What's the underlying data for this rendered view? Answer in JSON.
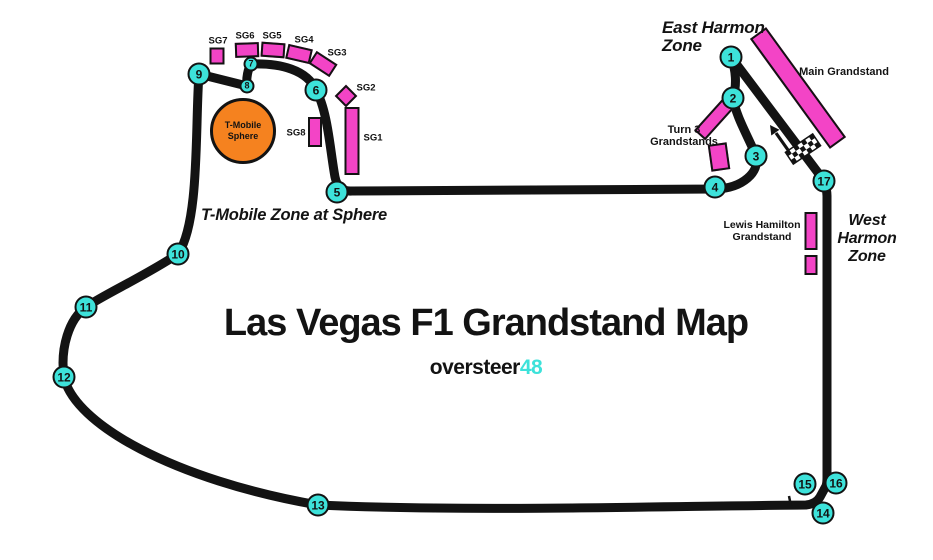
{
  "title": "Las Vegas F1 Grandstand Map",
  "brand": {
    "name": "oversteer",
    "number": "48"
  },
  "colors": {
    "pink": "#f344c6",
    "cyan": "#3de2da",
    "orange": "#f5821f",
    "track": "#131313",
    "background": "#ffffff"
  },
  "sphere": {
    "line1": "T-Mobile",
    "line2": "Sphere"
  },
  "zones": {
    "east_harmon": {
      "lines": [
        "East Harmon",
        "Zone"
      ]
    },
    "west_harmon": {
      "lines": [
        "West",
        "Harmon",
        "Zone"
      ]
    },
    "sphere_zone": {
      "lines": [
        "T-Mobile Zone at Sphere"
      ]
    },
    "turn3_label": {
      "lines": [
        "Turn 3",
        "Grandstands"
      ]
    },
    "lewis_label": {
      "lines": [
        "Lewis Hamilton",
        "Grandstand"
      ]
    },
    "main_label": {
      "lines": [
        "Main Grandstand"
      ]
    }
  },
  "turns": [
    {
      "n": "1",
      "x": 731,
      "y": 57,
      "size": "large"
    },
    {
      "n": "2",
      "x": 733,
      "y": 98,
      "size": "large"
    },
    {
      "n": "3",
      "x": 756,
      "y": 156,
      "size": "large"
    },
    {
      "n": "4",
      "x": 715,
      "y": 187,
      "size": "large"
    },
    {
      "n": "5",
      "x": 337,
      "y": 192,
      "size": "large"
    },
    {
      "n": "6",
      "x": 316,
      "y": 90,
      "size": "large"
    },
    {
      "n": "7",
      "x": 251,
      "y": 64,
      "size": "small"
    },
    {
      "n": "8",
      "x": 247,
      "y": 86,
      "size": "small"
    },
    {
      "n": "9",
      "x": 199,
      "y": 74,
      "size": "large"
    },
    {
      "n": "10",
      "x": 178,
      "y": 254,
      "size": "large"
    },
    {
      "n": "11",
      "x": 86,
      "y": 307,
      "size": "large"
    },
    {
      "n": "12",
      "x": 64,
      "y": 377,
      "size": "large"
    },
    {
      "n": "13",
      "x": 318,
      "y": 505,
      "size": "large"
    },
    {
      "n": "14",
      "x": 823,
      "y": 513,
      "size": "large"
    },
    {
      "n": "15",
      "x": 805,
      "y": 484,
      "size": "large"
    },
    {
      "n": "16",
      "x": 836,
      "y": 483,
      "size": "large"
    },
    {
      "n": "17",
      "x": 824,
      "y": 181,
      "size": "large"
    }
  ],
  "grandstands": [
    {
      "id": "sg7",
      "label": "SG7",
      "x": 217,
      "y": 56,
      "w": 15,
      "h": 17,
      "rot": 0,
      "lx": 218,
      "ly": 41
    },
    {
      "id": "sg6",
      "label": "SG6",
      "x": 247,
      "y": 50,
      "w": 24,
      "h": 15,
      "rot": -2,
      "lx": 245,
      "ly": 36
    },
    {
      "id": "sg5",
      "label": "SG5",
      "x": 273,
      "y": 50,
      "w": 24,
      "h": 15,
      "rot": 4,
      "lx": 272,
      "ly": 36
    },
    {
      "id": "sg4",
      "label": "SG4",
      "x": 299,
      "y": 54,
      "w": 25,
      "h": 15,
      "rot": 13,
      "lx": 304,
      "ly": 40
    },
    {
      "id": "sg3",
      "label": "SG3",
      "x": 323,
      "y": 64,
      "w": 25,
      "h": 15,
      "rot": 33,
      "lx": 337,
      "ly": 53
    },
    {
      "id": "sg2",
      "label": "SG2",
      "x": 346,
      "y": 96,
      "w": 16,
      "h": 16,
      "rot": 45,
      "lx": 366,
      "ly": 88
    },
    {
      "id": "sg1",
      "label": "SG1",
      "x": 352,
      "y": 141,
      "w": 15,
      "h": 68,
      "rot": 0,
      "lx": 373,
      "ly": 138
    },
    {
      "id": "sg8",
      "label": "SG8",
      "x": 315,
      "y": 132,
      "w": 14,
      "h": 30,
      "rot": 0,
      "lx": 296,
      "ly": 133
    },
    {
      "id": "main-grandstand",
      "label": "",
      "x": 798,
      "y": 88,
      "w": 136,
      "h": 20,
      "rot": 54,
      "lx": 0,
      "ly": 0
    },
    {
      "id": "turn3-upper",
      "label": "",
      "x": 717,
      "y": 116,
      "w": 52,
      "h": 15,
      "rot": -48,
      "lx": 0,
      "ly": 0
    },
    {
      "id": "turn3-lower",
      "label": "",
      "x": 719,
      "y": 157,
      "w": 19,
      "h": 27,
      "rot": -8,
      "lx": 0,
      "ly": 0
    },
    {
      "id": "lewis-tall",
      "label": "",
      "x": 811,
      "y": 231,
      "w": 13,
      "h": 38,
      "rot": 0,
      "lx": 0,
      "ly": 0
    },
    {
      "id": "lewis-small",
      "label": "",
      "x": 811,
      "y": 265,
      "w": 13,
      "h": 20,
      "rot": 0,
      "lx": 0,
      "ly": 0
    }
  ]
}
